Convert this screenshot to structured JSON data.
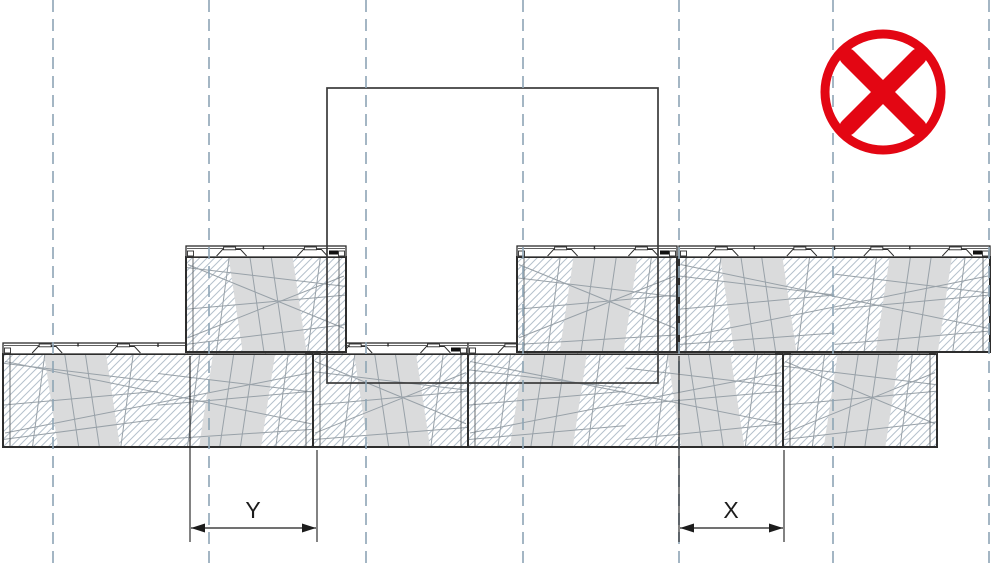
{
  "drawing": {
    "width": 992,
    "height": 565,
    "description": "block-wall-cross-section-incorrect-joint-offset",
    "colors": {
      "background": "#ffffff",
      "outline": "#2d2d2d",
      "hatch": "#b5c1cc",
      "texture": "#98a1a8",
      "band_fill": "#dadbdc",
      "grid_line": "#8fa6b6",
      "dimension": "#1c1c1c",
      "prohibition_red": "#e30613"
    },
    "module_width": 155,
    "grid": {
      "xs": [
        53,
        209,
        366,
        523,
        679,
        833,
        989
      ],
      "dash": "12 7",
      "stroke_width": 1.8
    },
    "courses": [
      {
        "name": "lower-course",
        "lip_top": 343,
        "lip_height": 11,
        "body_bottom": 447,
        "blocks": [
          {
            "x": 3,
            "w": 310
          },
          {
            "x": 313,
            "w": 155
          },
          {
            "x": 468,
            "w": 315
          },
          {
            "x": 783,
            "w": 154
          }
        ]
      },
      {
        "name": "upper-course",
        "lip_top": 246,
        "lip_height": 11,
        "body_bottom": 352,
        "blocks": [
          {
            "x": 186,
            "w": 160
          },
          {
            "x": 517,
            "w": 160
          },
          {
            "x": 679,
            "w": 311
          }
        ]
      }
    ],
    "outline_block": {
      "x": 327,
      "y": 88,
      "w": 331,
      "h": 295
    },
    "dimensions": [
      {
        "label": "Y",
        "x1": 190,
        "x2": 317,
        "line_y": 528,
        "label_x": 253,
        "label_y": 518,
        "ext1_top": 356,
        "ext2_top": 450,
        "ext_bottom": 542
      },
      {
        "label": "X",
        "x1": 679,
        "x2": 784,
        "line_y": 528,
        "label_x": 731,
        "label_y": 518,
        "ext1_top": 356,
        "ext2_top": 450,
        "ext_bottom": 542
      }
    ],
    "prohibition_icon": {
      "cx": 883,
      "cy": 92,
      "ring_r": 58,
      "ring_stroke": 9,
      "x_half": 35,
      "x_stroke": 17
    }
  }
}
